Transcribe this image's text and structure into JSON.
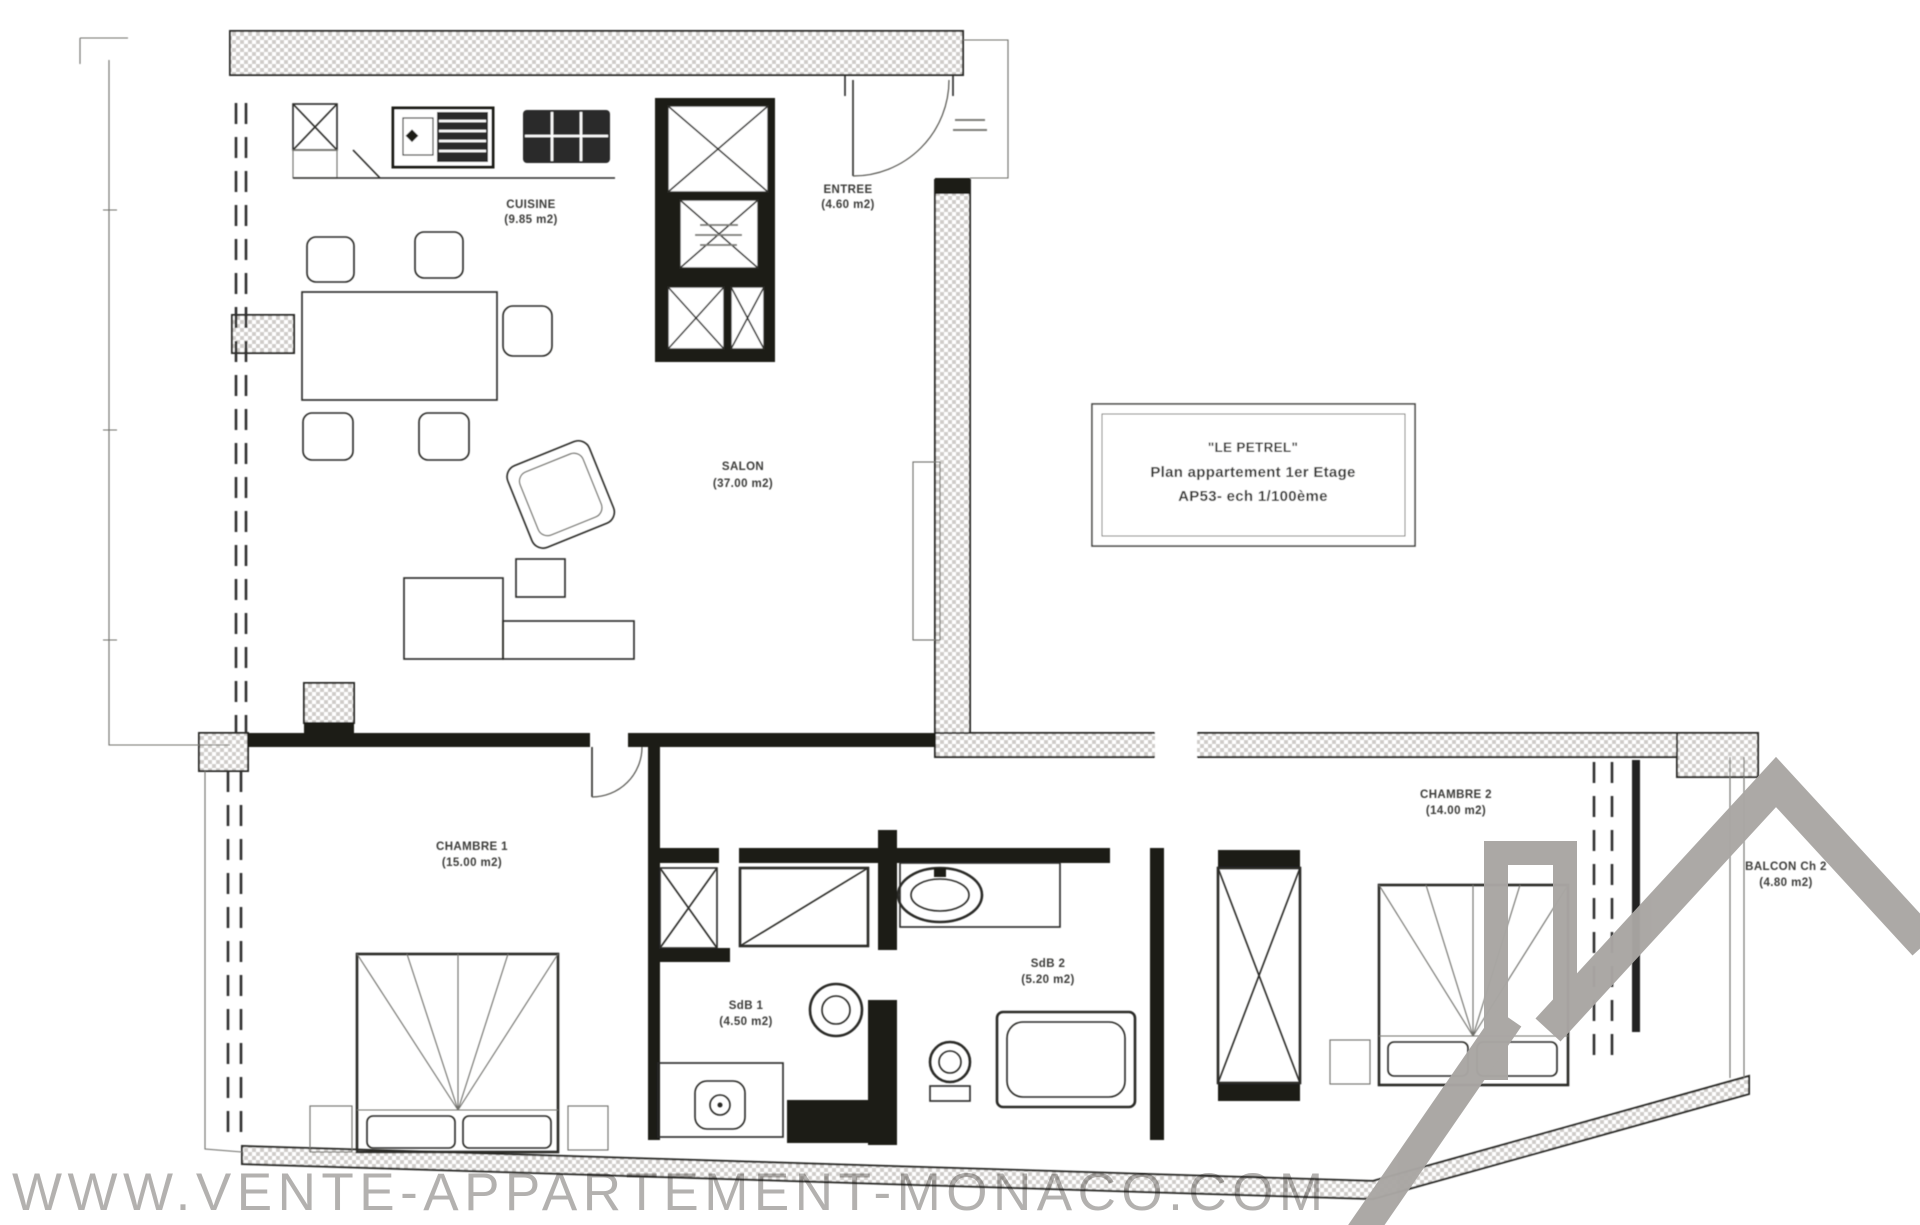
{
  "title_block": {
    "line1": "\"LE PETREL\"",
    "line2": "Plan appartement 1er Etage",
    "line3": "AP53- ech 1/100ème"
  },
  "rooms": {
    "cuisine": {
      "name": "CUISINE",
      "area": "(9.85 m2)"
    },
    "entree": {
      "name": "ENTREE",
      "area": "(4.60 m2)"
    },
    "salon": {
      "name": "SALON",
      "area": "(37.00 m2)"
    },
    "chambre1": {
      "name": "CHAMBRE 1",
      "area": "(15.00 m2)"
    },
    "sdb1": {
      "name": "SdB 1",
      "area": "(4.50 m2)"
    },
    "sdb2": {
      "name": "SdB 2",
      "area": "(5.20 m2)"
    },
    "chambre2": {
      "name": "CHAMBRE 2",
      "area": "(14.00 m2)"
    },
    "balcon": {
      "name": "BALCON Ch 2",
      "area": "(4.80 m2)"
    }
  },
  "watermark": {
    "text": "WWW.VENTE-APPARTEMENT-MONACO.COM"
  },
  "colors": {
    "logo_gray": "#a9a6a3",
    "watermark_gray": "#b3b1af",
    "line_dark": "#2a2a28",
    "hatch_gray": "#cfccc9"
  }
}
